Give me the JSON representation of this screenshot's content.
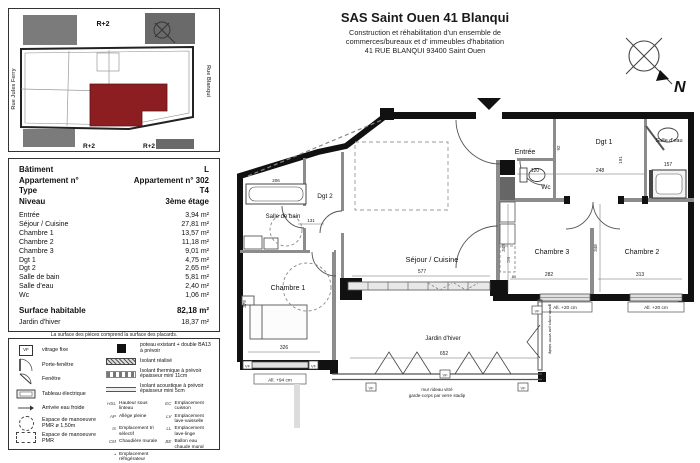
{
  "header": {
    "title": "SAS Saint Ouen 41 Blanqui",
    "line1": "Construction et réhabilitation d'un ensemble de",
    "line2": "commerces/bureaux et d' immeubles d'habitation",
    "line3": "41 RUE BLANQUI  93400 Saint Ouen"
  },
  "compass": {
    "label": "N"
  },
  "siteplan": {
    "floor_labels": [
      "R+2",
      "R+2",
      "R+2"
    ],
    "street_left": "Rue Jules Ferry",
    "street_right": "Rue Blanqui",
    "highlight_color": "#8c1d20"
  },
  "info": {
    "head": [
      {
        "label": "Bâtiment",
        "value": "L"
      },
      {
        "label": "Appartement n°",
        "value": "Appartement n° 302"
      },
      {
        "label": "Type",
        "value": "T4"
      },
      {
        "label": "Niveau",
        "value": "3ème étage"
      }
    ],
    "rooms": [
      {
        "label": "Entrée",
        "value": "3,94 m²"
      },
      {
        "label": "Séjour / Cuisine",
        "value": "27,81 m²"
      },
      {
        "label": "Chambre 1",
        "value": "13,57 m²"
      },
      {
        "label": "Chambre 2",
        "value": "11,18 m²"
      },
      {
        "label": "Chambre 3",
        "value": "9,01 m²"
      },
      {
        "label": "Dgt 1",
        "value": "4,75 m²"
      },
      {
        "label": "Dgt 2",
        "value": "2,65 m²"
      },
      {
        "label": "Salle de bain",
        "value": "5,81 m²"
      },
      {
        "label": "Salle d'eau",
        "value": "2,40 m²"
      },
      {
        "label": "Wc",
        "value": "1,06 m²"
      }
    ],
    "total": {
      "label": "Surface habitable",
      "value": "82,18 m²"
    },
    "winter": {
      "label": "Jardin d'hiver",
      "value": "18,37 m²"
    },
    "note1": "La surface des pièces comprend la surface des placards.",
    "note2": "Les hauteurs d'allège, seuil et hauteurs sous plafond sont des cotes brutes hors finitions."
  },
  "legend": {
    "vf_text": "VF",
    "left": [
      {
        "label": "vitrage fixe"
      },
      {
        "label": "Porte-fenêtre"
      },
      {
        "label": "Fenêtre"
      },
      {
        "label": "Tableau électrique"
      },
      {
        "label": "Arrivée eau froide"
      },
      {
        "label": "Espace de manoeuvre PMR ø 1,50m"
      },
      {
        "label": "Espace de manoeuvre PMR"
      }
    ],
    "strips": [
      {
        "label": "poteau existant + double BA13 à prévoir"
      },
      {
        "label": "Isolant réalisé"
      },
      {
        "label": "Isolant thermique à prévoir épaisseur mini 11cm"
      },
      {
        "label": "Isolant acoustique à prévoir épaisseur mini 5cm"
      }
    ],
    "abbrevs": [
      {
        "key": "HSL",
        "label": "Hauteur sous linteau"
      },
      {
        "key": "AP",
        "label": "Allège pleine"
      },
      {
        "key": "ts",
        "label": "Emplacement tri sélectif"
      },
      {
        "key": "CM",
        "label": "Chaudière murale"
      },
      {
        "key": "•",
        "label": "Emplacement réfrigérateur"
      },
      {
        "key": "EC",
        "label": "Emplacement cuisson"
      },
      {
        "key": "LV",
        "label": "Emplacement lave-vaisselle"
      },
      {
        "key": "LL",
        "label": "Emplacement lave-linge"
      },
      {
        "key": "BE",
        "label": "Ballon eau chaude mural"
      }
    ]
  },
  "plan": {
    "rooms": {
      "entree": "Entrée",
      "wc": "Wc",
      "dgt1": "Dgt 1",
      "salle_eau": "Salle d'eau",
      "dgt2": "Dgt 2",
      "salle_de_bain": "Salle de bain",
      "sejour": "Séjour / Cuisine",
      "chambre1": "Chambre 1",
      "chambre2": "Chambre 2",
      "chambre3": "Chambre 3",
      "jardin": "Jardin d'hiver"
    },
    "dims": {
      "wc_w": "120",
      "dgt1_w": "248",
      "se_w": "157",
      "ent_h": "92",
      "dgt1_h": "191",
      "ch3_h": "348",
      "ch2_h": "348",
      "ch3_w": "282",
      "ch2_w": "313",
      "sej_w": "577",
      "k": "80",
      "dgt2_w": "131",
      "bain_w": "206",
      "ch1_w": "326",
      "ch1_h": "379",
      "jardin_w": "652"
    },
    "annots": {
      "allege20": "All. +20 cm",
      "allege94": "All. +94 cm",
      "vf": "VF",
      "curtain1": "mur rideau vitré",
      "curtain2": "garde-corps par verre stadip"
    }
  }
}
